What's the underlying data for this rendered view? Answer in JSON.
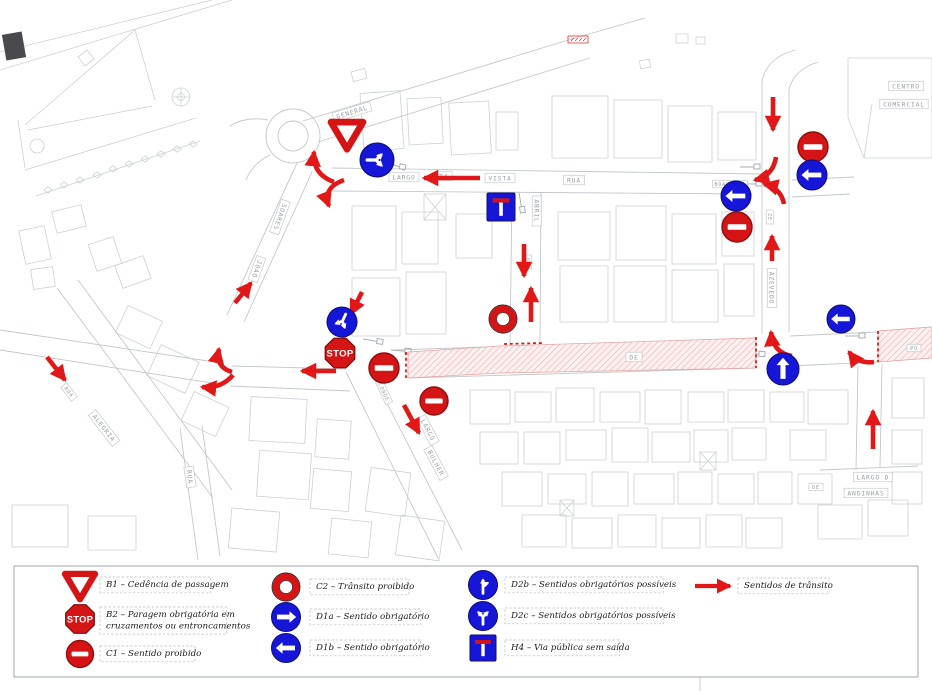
{
  "colors": {
    "sign_red": "#d51515",
    "sign_red_dark": "#8f0f0f",
    "sign_blue": "#1616d9",
    "sign_blue_dark": "#0d0d6e",
    "arrow_red": "#e21818",
    "closure_pink": "#fdf0f0",
    "closure_hatch": "#edb5b5",
    "line_gray": "#c3c7cb",
    "label_gray": "#9aa0a6"
  },
  "strings": {
    "stop": "STOP"
  },
  "map": {
    "signs": [
      {
        "id": "yield-general",
        "type": "yield",
        "x": 347,
        "y": 134,
        "s": 16
      },
      {
        "id": "fork-largo",
        "type": "fork-y",
        "x": 377,
        "y": 160,
        "r": 17,
        "rot": 90
      },
      {
        "id": "dead-end-abril",
        "type": "dead-end",
        "x": 501,
        "y": 207,
        "s": 14
      },
      {
        "id": "forbidden-abril",
        "type": "forbidden",
        "x": 503,
        "y": 319,
        "r": 14
      },
      {
        "id": "fork-stop",
        "type": "fork-y",
        "x": 342,
        "y": 322,
        "r": 15,
        "rot": 205
      },
      {
        "id": "stop-junction",
        "type": "stop",
        "x": 340,
        "y": 353,
        "r": 16
      },
      {
        "id": "no-entry-stop",
        "type": "no-entry",
        "x": 384,
        "y": 368,
        "r": 15
      },
      {
        "id": "no-entry-bulher",
        "type": "no-entry",
        "x": 434,
        "y": 401,
        "r": 14
      },
      {
        "id": "no-entry-azevedo-north",
        "type": "no-entry",
        "x": 813,
        "y": 147,
        "r": 15
      },
      {
        "id": "left-azevedo-north",
        "type": "left",
        "x": 812,
        "y": 175,
        "r": 15
      },
      {
        "id": "left-boavista-east",
        "type": "left",
        "x": 736,
        "y": 196,
        "r": 15
      },
      {
        "id": "no-entry-azevedo-south",
        "type": "no-entry",
        "x": 737,
        "y": 227,
        "r": 15
      },
      {
        "id": "left-main-east",
        "type": "left",
        "x": 841,
        "y": 319,
        "r": 14
      },
      {
        "id": "up-main-junction",
        "type": "up",
        "x": 783,
        "y": 369,
        "r": 16
      }
    ],
    "arrows": [
      {
        "x1": 480,
        "y1": 178,
        "x2": 424,
        "y2": 178
      },
      {
        "x1": 524,
        "y1": 244,
        "x2": 524,
        "y2": 276
      },
      {
        "x1": 531,
        "y1": 322,
        "x2": 531,
        "y2": 288
      },
      {
        "x1": 773,
        "y1": 97,
        "x2": 773,
        "y2": 130
      },
      {
        "x1": 772,
        "y1": 261,
        "x2": 772,
        "y2": 236
      },
      {
        "x1": 873,
        "y1": 449,
        "x2": 873,
        "y2": 411
      },
      {
        "x1": 336,
        "y1": 371,
        "x2": 302,
        "y2": 371
      },
      {
        "x1": 404,
        "y1": 405,
        "x2": 419,
        "y2": 433
      },
      {
        "x1": 235,
        "y1": 303,
        "x2": 251,
        "y2": 283
      },
      {
        "x1": 47,
        "y1": 357,
        "x2": 65,
        "y2": 380
      },
      {
        "x1": 362,
        "y1": 292,
        "x2": 351,
        "y2": 314
      },
      {
        "path": "M334,182 Q312,174 314,152"
      },
      {
        "path": "M344,180 Q322,188 329,206"
      },
      {
        "path": "M232,372 Q215,367 219,349"
      },
      {
        "path": "M233,375 Q221,389 202,387"
      },
      {
        "path": "M776,157 Q773,176 755,180"
      },
      {
        "path": "M784,204 Q781,188 764,184"
      },
      {
        "path": "M792,356 Q773,353 771,332"
      },
      {
        "path": "M874,362 Q858,364 849,352"
      }
    ],
    "labels": [
      {
        "text": "GENERAL",
        "x": 352,
        "y": 112,
        "rot": -17
      },
      {
        "text": "LARGO",
        "x": 404,
        "y": 177,
        "rot": 0
      },
      {
        "text": "DA",
        "x": 444,
        "y": 176,
        "rot": 0
      },
      {
        "text": "VISTA",
        "x": 500,
        "y": 178,
        "rot": 0
      },
      {
        "text": "RUA",
        "x": 574,
        "y": 180,
        "rot": 0
      },
      {
        "text": "BOAVISTA",
        "x": 730,
        "y": 184,
        "rot": 0,
        "sm": 1
      },
      {
        "text": "ABRIL",
        "x": 537,
        "y": 211,
        "rot": 90
      },
      {
        "text": "DE",
        "x": 528,
        "y": 262,
        "rot": 90,
        "sm": 1
      },
      {
        "text": "ZE",
        "x": 770,
        "y": 217,
        "rot": 90,
        "sm": 1
      },
      {
        "text": "AZEVEDO",
        "x": 772,
        "y": 288,
        "rot": 90
      },
      {
        "text": "SOARES",
        "x": 280,
        "y": 217,
        "rot": 110
      },
      {
        "text": "JOAO",
        "x": 257,
        "y": 269,
        "rot": 110
      },
      {
        "text": "RUA",
        "x": 190,
        "y": 477,
        "rot": 82
      },
      {
        "text": "ALEGRIA",
        "x": 104,
        "y": 428,
        "rot": 52
      },
      {
        "text": "RUA",
        "x": 69,
        "y": 392,
        "rot": 52,
        "sm": 1
      },
      {
        "text": "CONDE",
        "x": 384,
        "y": 392,
        "rot": 65,
        "sm": 1
      },
      {
        "text": "LARGO",
        "x": 428,
        "y": 430,
        "rot": 62
      },
      {
        "text": "BULHER",
        "x": 436,
        "y": 463,
        "rot": 62
      },
      {
        "text": "CENTRO",
        "x": 906,
        "y": 86,
        "rot": 0
      },
      {
        "text": "COMERCIAL",
        "x": 904,
        "y": 104,
        "rot": 0
      },
      {
        "text": "DE",
        "x": 634,
        "y": 357,
        "rot": 0
      },
      {
        "text": "PO",
        "x": 914,
        "y": 348,
        "rot": 0,
        "sm": 1
      },
      {
        "text": "LARGO D",
        "x": 873,
        "y": 477,
        "rot": 0
      },
      {
        "text": "ANDINHAS",
        "x": 866,
        "y": 493,
        "rot": 0
      },
      {
        "text": "DE",
        "x": 816,
        "y": 487,
        "rot": 0,
        "sm": 1
      }
    ]
  },
  "legend": {
    "items": [
      {
        "code": "B1",
        "type": "yield",
        "icon": {
          "x": 80,
          "y": 585,
          "s": 15
        },
        "text": {
          "x": 100,
          "y": 577
        },
        "lines": [
          "B1 – Cedência de passagem"
        ]
      },
      {
        "code": "B2",
        "type": "stop",
        "icon": {
          "x": 80,
          "y": 619,
          "r": 15.5
        },
        "text": {
          "x": 100,
          "y": 607
        },
        "lines": [
          "B2 – Paragem obrigatória em",
          "cruzamentos ou entroncamentos"
        ]
      },
      {
        "code": "C1",
        "type": "no-entry",
        "icon": {
          "x": 80,
          "y": 654,
          "r": 13.5
        },
        "text": {
          "x": 100,
          "y": 646
        },
        "lines": [
          "C1 – Sentido proibido"
        ]
      },
      {
        "code": "C2",
        "type": "forbidden",
        "icon": {
          "x": 286,
          "y": 587,
          "r": 14
        },
        "text": {
          "x": 310,
          "y": 579
        },
        "lines": [
          "C2 – Trânsito proibido"
        ]
      },
      {
        "code": "D1a",
        "type": "right",
        "icon": {
          "x": 286,
          "y": 617,
          "r": 14.5
        },
        "text": {
          "x": 310,
          "y": 609
        },
        "lines": [
          "D1a – Sentido obrigatório"
        ]
      },
      {
        "code": "D1b",
        "type": "left",
        "icon": {
          "x": 286,
          "y": 648,
          "r": 14.5
        },
        "text": {
          "x": 310,
          "y": 640
        },
        "lines": [
          "D1b – Sentido obrigatório"
        ]
      },
      {
        "code": "D2b",
        "type": "fork-up-right",
        "icon": {
          "x": 483,
          "y": 585,
          "r": 14.5
        },
        "text": {
          "x": 505,
          "y": 577
        },
        "lines": [
          "D2b – Sentidos obrigatórios possíveis"
        ]
      },
      {
        "code": "D2c",
        "type": "fork-y",
        "icon": {
          "x": 483,
          "y": 616,
          "r": 14.5
        },
        "text": {
          "x": 505,
          "y": 608
        },
        "lines": [
          "D2c – Sentidos obrigatórios possíveis"
        ]
      },
      {
        "code": "H4",
        "type": "dead-end",
        "icon": {
          "x": 483,
          "y": 648,
          "s": 13
        },
        "text": {
          "x": 505,
          "y": 640
        },
        "lines": [
          "H4 – Via pública sem saída"
        ]
      }
    ],
    "flow": {
      "lines": [
        "Sentidos de trânsito"
      ],
      "arrow": {
        "x1": 695,
        "y1": 586,
        "x2": 730,
        "y2": 586
      },
      "text": {
        "x": 738,
        "y": 578
      }
    }
  }
}
